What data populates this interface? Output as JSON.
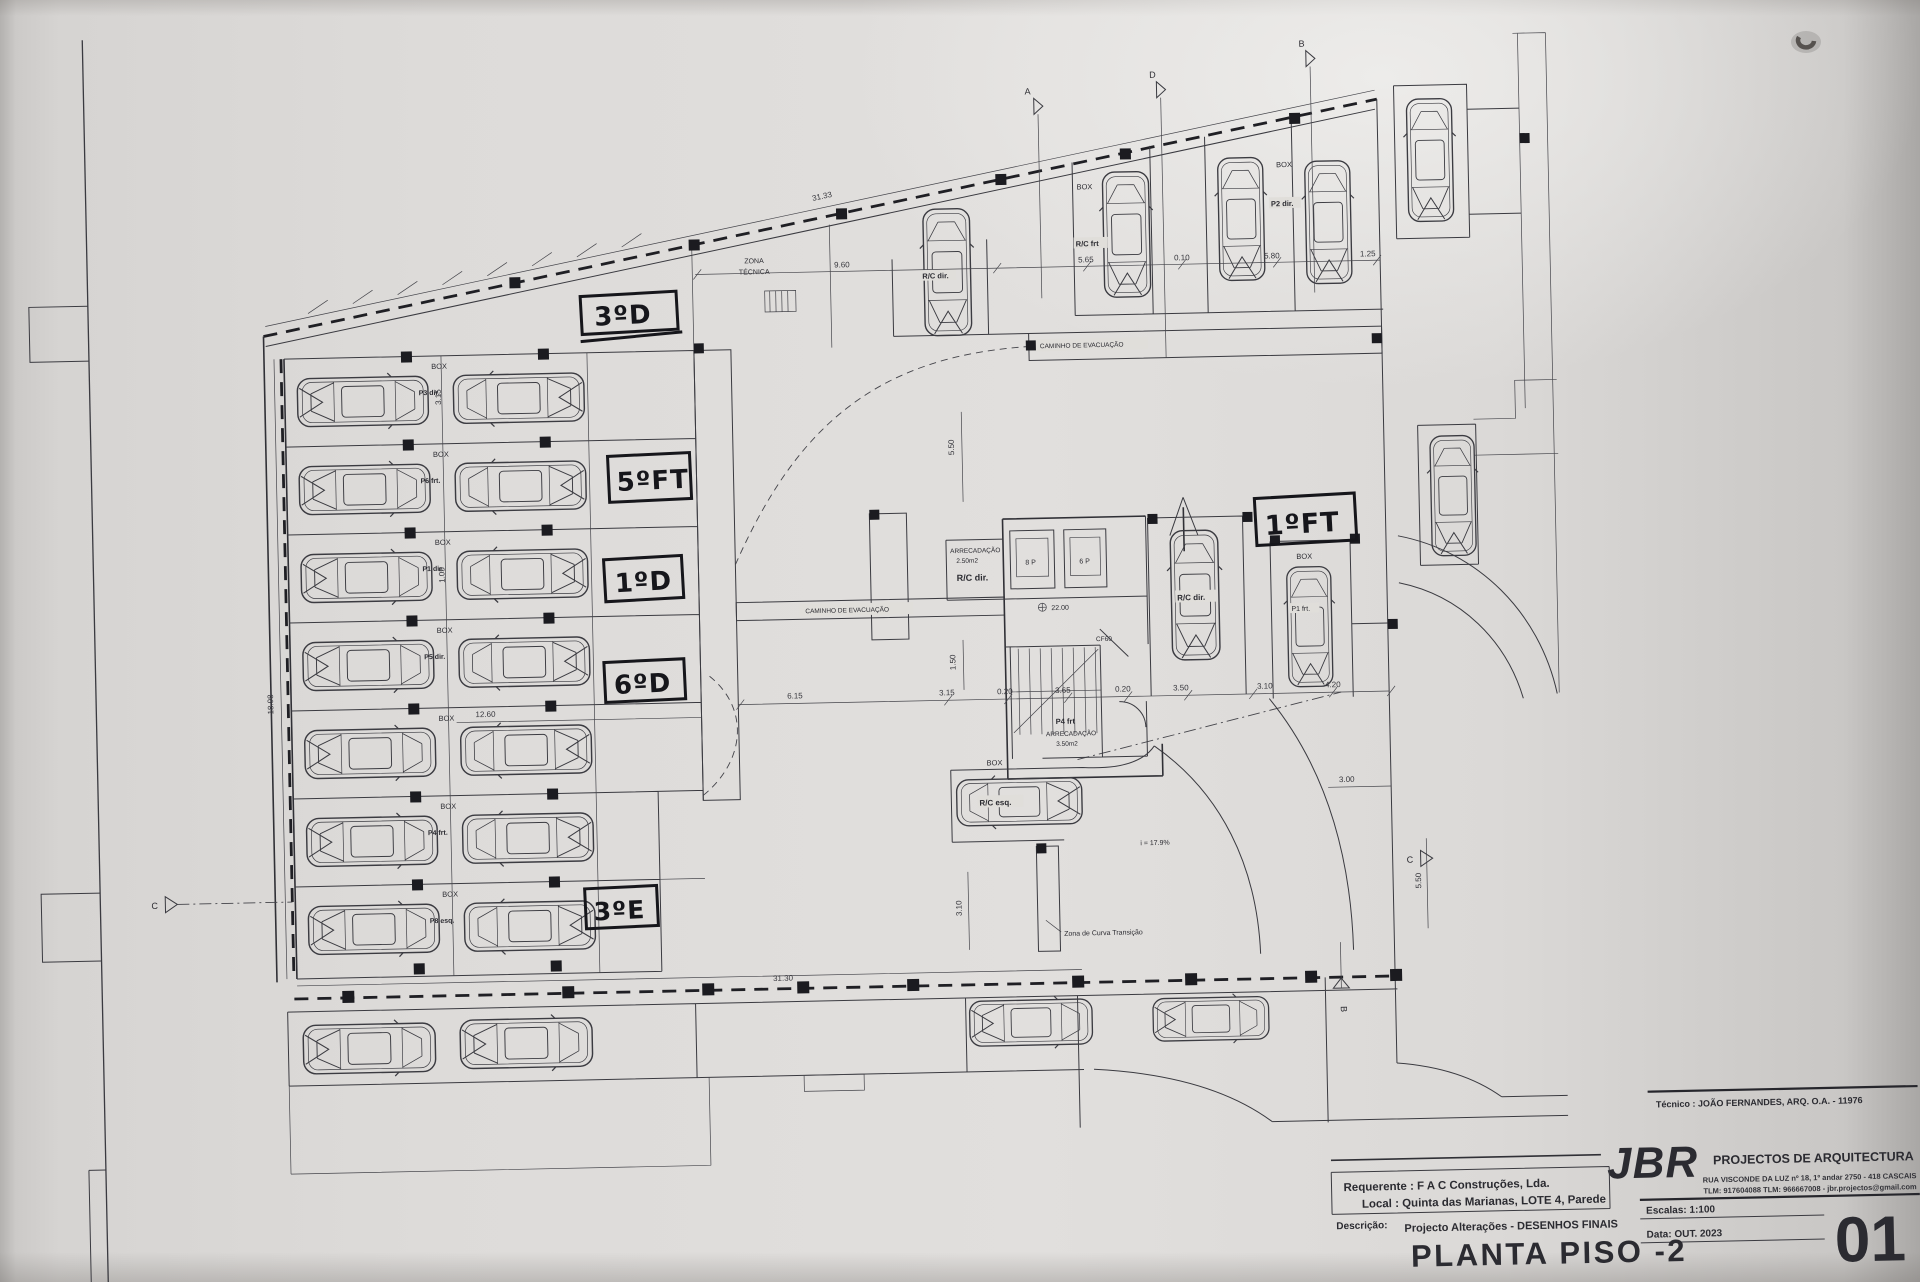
{
  "document": {
    "kind": "scanned architectural drawing",
    "floor": "basement level -2 parking plan"
  },
  "labels": {
    "box": "BOX",
    "zona_tecnica_1": "ZONA",
    "zona_tecnica_2": "TÉCNICA",
    "caminho": "CAMINHO DE EVACUAÇÃO",
    "zona_curva": "Zona de Curva Transição",
    "slope": "i = 17.9%",
    "rc_frt": "R/C frt",
    "p2_dir": "P2 dir.",
    "rc_dir": "R/C dir.",
    "rc_esq": "R/C esq.",
    "p1_frt": "P1 frt.",
    "p4_frt": "P4 frt",
    "arrecadacao": "ARRECADAÇÃO",
    "area_250": "2.50m2",
    "area_350": "3.50m2",
    "lift_8p": "8 P",
    "lift_6p": "6 P",
    "level": "22.00",
    "door": "CF60"
  },
  "rows": [
    {
      "id": "P3 dir."
    },
    {
      "id": "P6 frt."
    },
    {
      "id": "P1 dir."
    },
    {
      "id": "P5 dir."
    },
    {
      "id": ""
    },
    {
      "id": "P4 frt."
    },
    {
      "id": "P8 esq."
    }
  ],
  "handwritten": {
    "h1": "3ºD",
    "h2": "5ºFT",
    "h3": "1ºD",
    "h4": "6ºD",
    "h5": "3ºE",
    "h6": "1ºFT"
  },
  "dims": {
    "d3133": "31.33",
    "d960": "9.60",
    "d565": "5.65",
    "d010": "0.10",
    "d580": "5.80",
    "d125": "1.25",
    "d550a": "5.50",
    "d1898": "18.98",
    "d1260": "12.60",
    "d615": "6.15",
    "d315a": "3.15",
    "d020a": "0.20",
    "d365": "3.65",
    "d020b": "0.20",
    "d350": "3.50",
    "d310a": "3.10",
    "d420": "4.20",
    "d300": "3.00",
    "d550b": "5.50",
    "d3130": "31.30",
    "d310v": "3.10",
    "d150": "1.50",
    "d315r": "3.15",
    "d105": "1.05"
  },
  "markers": {
    "a": "A",
    "b": "B",
    "c": "C",
    "d": "D"
  },
  "title_block": {
    "technician": "Técnico : JOÃO FERNANDES, ARQ.   O.A. - 11976",
    "jbr": "JBR",
    "firm": "PROJECTOS DE ARQUITECTURA",
    "address": "RUA VISCONDE DA LUZ nº 18, 1º andar  2750 - 418  CASCAIS",
    "contacts": "TLM: 917604088  TLM: 966667008 - jbr.projectos@gmail.com",
    "requerente": "Requerente : F A C  Construções, Lda.",
    "local": "Local : Quinta das Marianas, LOTE 4, Parede",
    "descricao_label": "Descrição:",
    "descricao": "Projecto Alterações - DESENHOS FINAIS",
    "title": "PLANTA PISO -2",
    "escala": "Escalas:  1:100",
    "data": "Data:  OUT.  2023",
    "sheet": "01"
  }
}
